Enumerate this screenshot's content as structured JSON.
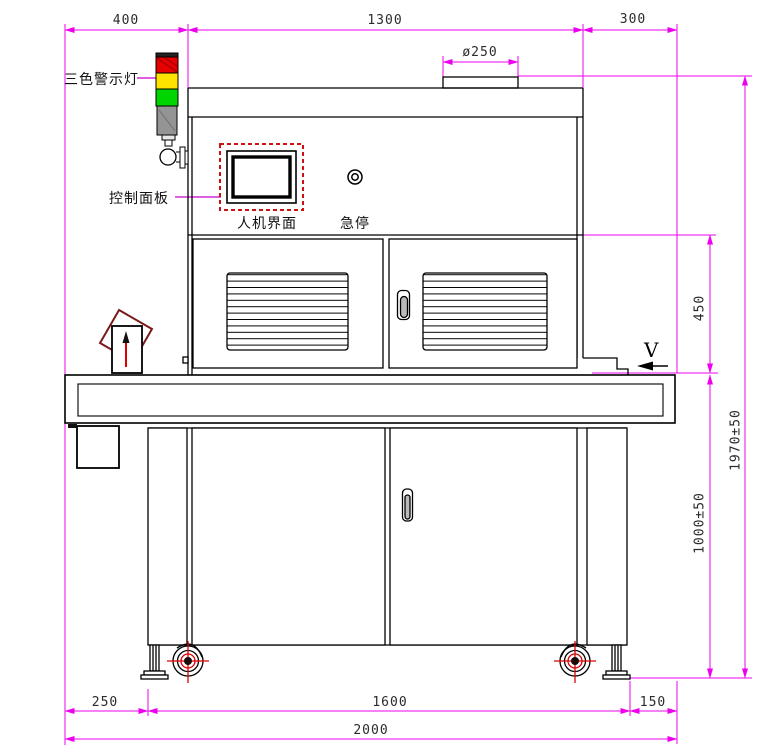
{
  "labels": {
    "tower_light": "三色警示灯",
    "control_panel": "控制面板",
    "hmi_screen": "人机界面",
    "emergency_stop": "急停",
    "view_marker": "V"
  },
  "dims": {
    "top_left": "400",
    "top_middle": "1300",
    "top_right": "300",
    "duct_diameter": "ø250",
    "upper_section_height": "450",
    "table_height": "1000±50",
    "overall_height": "1970±50",
    "bottom_left": "250",
    "bottom_middle": "1600",
    "bottom_right": "150",
    "overall_width": "2000"
  },
  "colors": {
    "dimension": "#ee00ee",
    "leader": "#cc00cc",
    "light_red": "#e60000",
    "light_yellow": "#ffe300",
    "light_green": "#00d500",
    "light_pole_gray": "#949494",
    "screen_border_red": "#cc1111",
    "crosshair_red": "#dd0000",
    "diamond_maroon": "#7a1a1a",
    "handle_gray": "#b9b9b9"
  }
}
